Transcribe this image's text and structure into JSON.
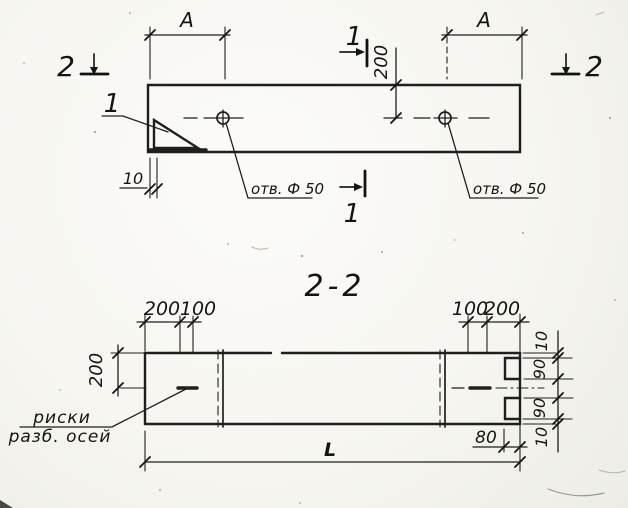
{
  "plan": {
    "dim_a_left": "A",
    "dim_a_right": "A",
    "dim_200": "200",
    "dim_10": "10",
    "hole_left": "отв. Ф 50",
    "hole_right": "отв. Ф 50",
    "detail_callout": "1",
    "sec1_top": "1",
    "sec1_bottom": "1",
    "sec2_left": "2",
    "sec2_right": "2"
  },
  "section": {
    "title": "2-2",
    "tl_200": "200",
    "tl_100": "100",
    "tr_100": "100",
    "tr_200": "200",
    "left_200": "200",
    "r_10_top": "10",
    "r_90_top": "90",
    "r_90_bot": "90",
    "r_10_bot": "10",
    "dim_80": "80",
    "dim_l": "L",
    "note_line1": "риски",
    "note_line2": "разб. осей"
  },
  "colors": {
    "ink": "#1f1f1f",
    "paper": "#f7f6f1"
  }
}
